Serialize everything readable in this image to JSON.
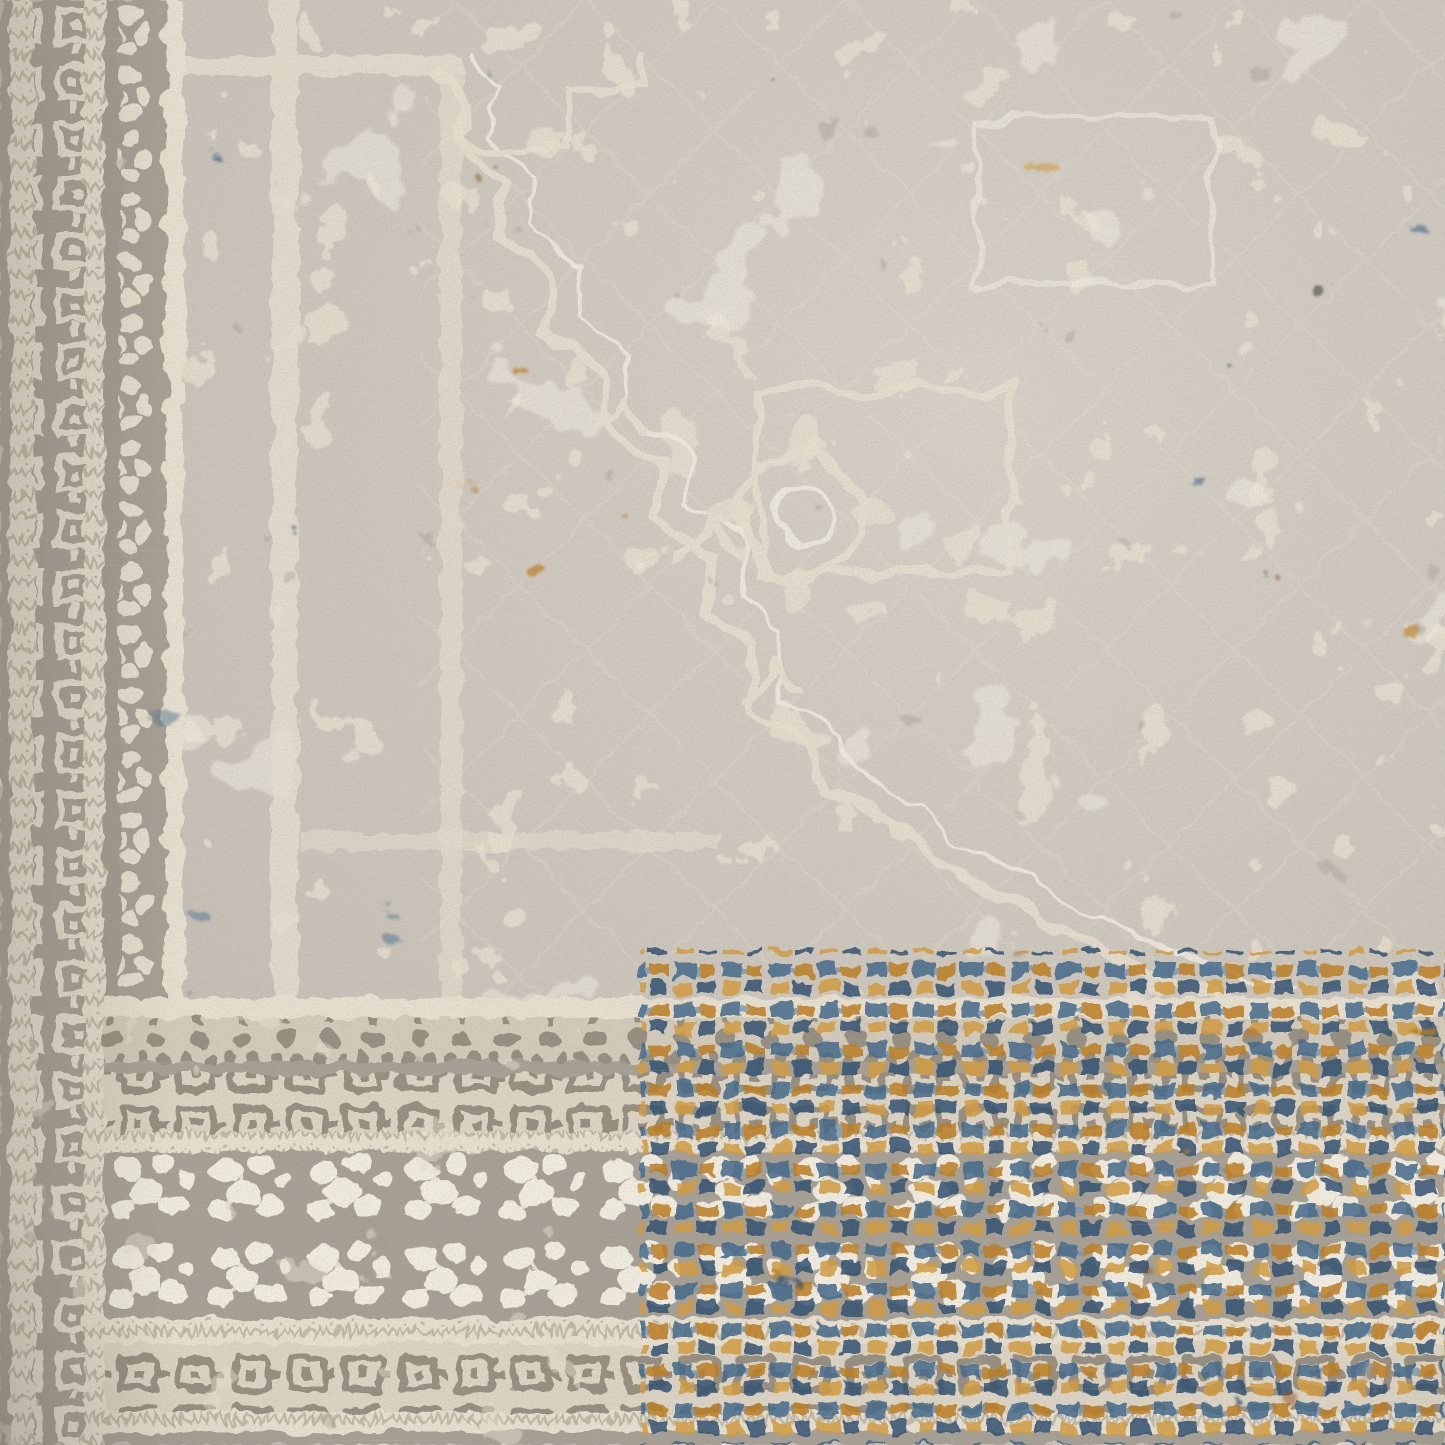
{
  "image": {
    "type": "photograph",
    "subject": "Distressed vintage-style oriental area rug, corner close-up",
    "description": "Close-up photograph of a machine-woven vintage-look rug. Warm gray field with eroded ivory medallion and herati motifs, abrash staining in steel blue and burnt gold. Left and bottom borders show meander guard stripes, a Greek-key band and an ivory floral main border; the lower-right border corner is densely saturated with blue and gold rows.",
    "alt": "Gray, ivory, blue and gold distressed oriental rug corner"
  },
  "palette": {
    "field_gray": "#c8c2b8",
    "field_light": "#d6d0c6",
    "ivory": "#e9e2d2",
    "ivory_bright": "#f3eee2",
    "border_gray": "#a7a095",
    "motif_gray": "#968f81",
    "shadow": "#a39c90",
    "key_bg": "#ddd6c6",
    "band_cream": "#d4cdbd",
    "meander_line": "#c2baa8",
    "steel_blue": "#41688b",
    "deep_blue": "#2e5070",
    "light_blue": "#7e9bb2",
    "gold": "#bf7d1f",
    "amber": "#d59d3c",
    "rust": "#8e4f12"
  },
  "regions": {
    "field": "Gray field with faded ivory herati motifs and abrash stains",
    "medallion": "Stepped diagonal edge of the central medallion with rosette",
    "left_border": "Left border: meander guard stripes, Greek-key band, floral band",
    "bottom_border": "Bottom border: florets, Greek-key bands and ivory floral main band",
    "corner_rows": "Saturated steel-blue and gold motif rows in the lower-right border",
    "stains": "Abrash colour staining in steel blue, gold and rust"
  }
}
